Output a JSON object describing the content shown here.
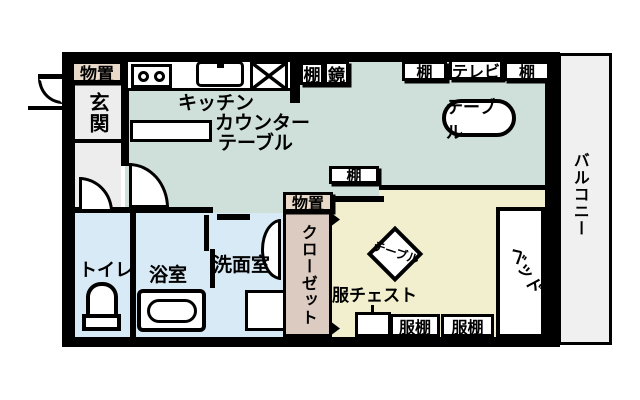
{
  "title": "ワンルーム間取り図",
  "colors": {
    "wall": "#000000",
    "living_floor": "#cfe0db",
    "bedroom_floor": "#f1efcd",
    "wetroom_floor": "#d8eaf6",
    "closet_floor": "#dccbc0",
    "storage_label_bg": "#e9d9c9",
    "hall_floor": "#ededed",
    "balcony_floor": "#f0f0f0"
  },
  "labels": {
    "storage_top": "物置",
    "entrance": "玄関",
    "kitchen_l1": "キッチン",
    "kitchen_l2": "カウンター",
    "kitchen_l3": "テーブル",
    "shelf_a": "棚",
    "mirror": "鏡",
    "shelf_b": "棚",
    "tv": "テレビ",
    "shelf_c": "棚",
    "living_table": "テーブル",
    "balcony": "バルコニー",
    "shelf_mid": "棚",
    "storage_mid": "物置",
    "closet": "クローゼット",
    "toilet": "トイレ",
    "bathroom": "浴室",
    "washroom": "洗面室",
    "bedroom_table": "テーブル",
    "clothes_chest": "服チェスト",
    "clothes_shelf_1": "服棚",
    "clothes_shelf_2": "服棚",
    "bed": "ベッド"
  }
}
